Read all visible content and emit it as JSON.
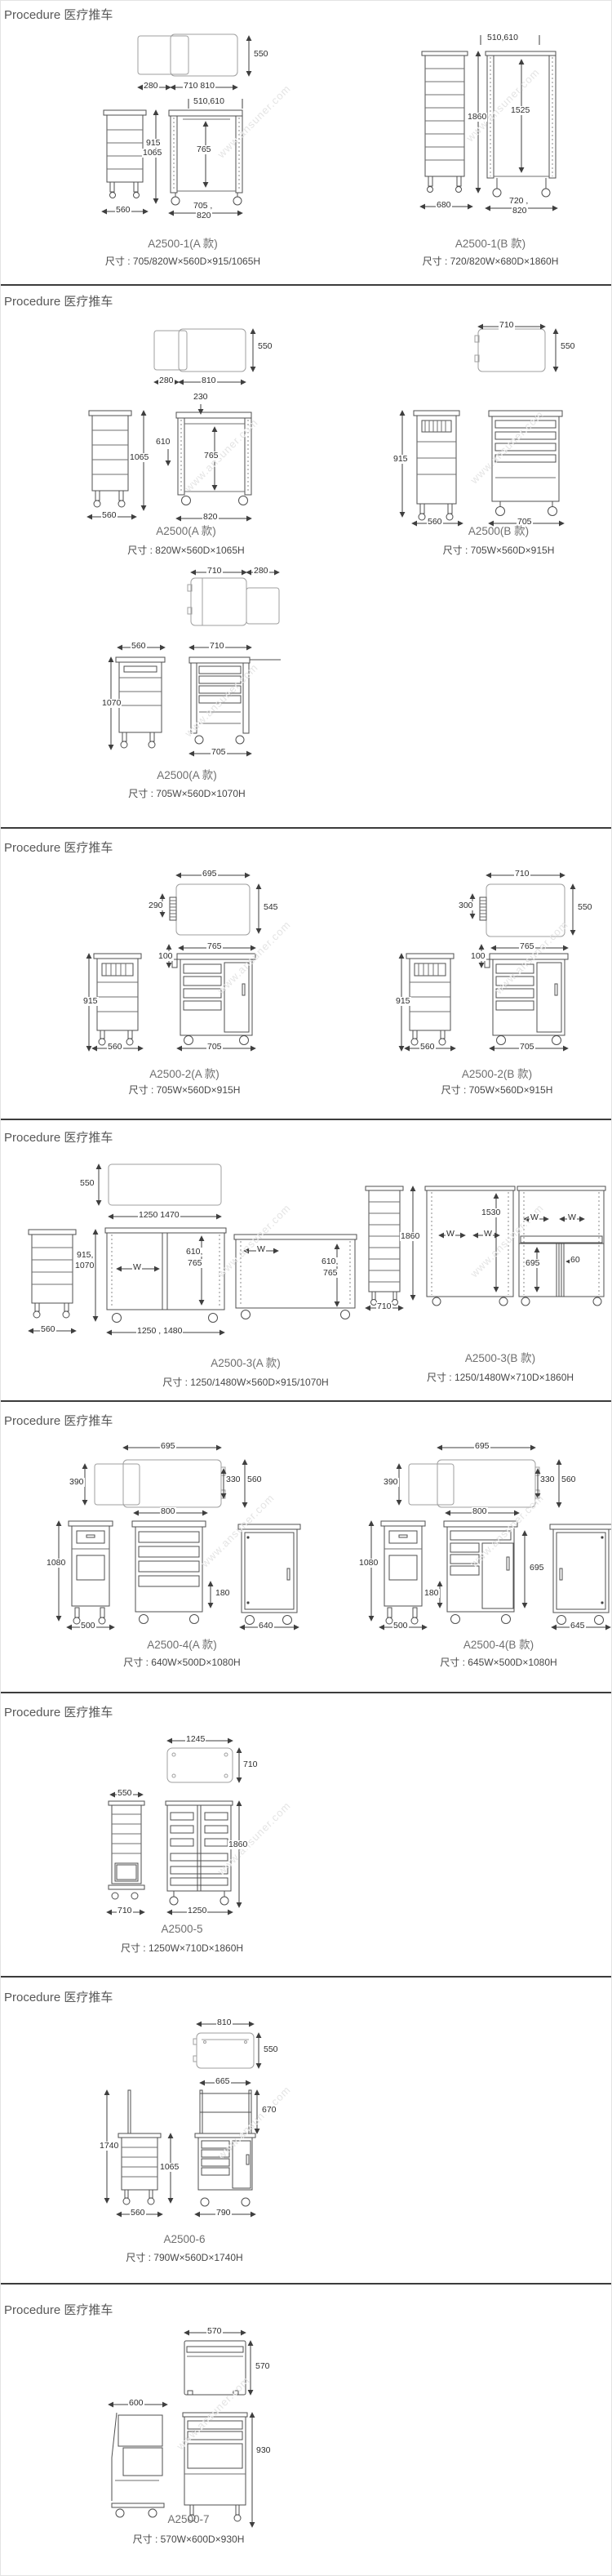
{
  "watermark": "www.ansuner.com",
  "sections": [
    {
      "header": "Procedure 医疗推车",
      "products": [
        {
          "name": "A2500-1(A 款)",
          "size": "尺寸 : 705/820W×560D×915/1065H",
          "dims": [
            "550",
            "280",
            "710 810",
            "510,610",
            "915",
            "1065",
            "765",
            "560",
            "705 ,",
            "820"
          ]
        },
        {
          "name": "A2500-1(B 款)",
          "size": "尺寸 : 720/820W×680D×1860H",
          "dims": [
            "510,610",
            "1860",
            "1525",
            "680",
            "720 ,",
            "820"
          ]
        }
      ]
    },
    {
      "header": "Procedure 医疗推车",
      "products": [
        {
          "name": "A2500(A 款)",
          "size": "尺寸 : 820W×560D×1065H",
          "dims": [
            "550",
            "280",
            "810",
            "230",
            "610",
            "765",
            "1065",
            "560",
            "820"
          ]
        },
        {
          "name": "A2500(B 款)",
          "size": "尺寸 : 705W×560D×915H",
          "dims": [
            "710",
            "550",
            "915",
            "560",
            "705"
          ]
        },
        {
          "name": "A2500(A 款)",
          "size": "尺寸 : 705W×560D×1070H",
          "dims": [
            "710",
            "280",
            "560",
            "710",
            "1070",
            "705"
          ]
        }
      ]
    },
    {
      "header": "Procedure 医疗推车",
      "products": [
        {
          "name": "A2500-2(A 款)",
          "size": "尺寸 : 705W×560D×915H",
          "dims": [
            "695",
            "290",
            "545",
            "765",
            "100",
            "915",
            "560",
            "705"
          ]
        },
        {
          "name": "A2500-2(B 款)",
          "size": "尺寸 : 705W×560D×915H",
          "dims": [
            "710",
            "300",
            "550",
            "765",
            "100",
            "915",
            "560",
            "705"
          ]
        }
      ]
    },
    {
      "header": "Procedure 医疗推车",
      "products": [
        {
          "name": "A2500-3(A 款)",
          "size": "尺寸 : 1250/1480W×560D×915/1070H",
          "dims": [
            "550",
            "1250 1470",
            "915,",
            "1070",
            "W",
            "610,",
            "765",
            "560",
            "1250 , 1480",
            "W",
            "610,",
            "765"
          ]
        },
        {
          "name": "A2500-3(B 款)",
          "size": "尺寸 : 1250/1480W×710D×1860H",
          "dims": [
            "1860",
            "710",
            "1530",
            "W",
            "W",
            "W",
            "W",
            "695",
            "60"
          ]
        }
      ]
    },
    {
      "header": "Procedure 医疗推车",
      "products": [
        {
          "name": "A2500-4(A 款)",
          "size": "尺寸 : 640W×500D×1080H",
          "dims": [
            "695",
            "390",
            "330",
            "560",
            "800",
            "1080",
            "180",
            "500",
            "640"
          ]
        },
        {
          "name": "A2500-4(B 款)",
          "size": "尺寸 : 645W×500D×1080H",
          "dims": [
            "695",
            "390",
            "330",
            "560",
            "800",
            "1080",
            "180",
            "695",
            "500",
            "645"
          ]
        }
      ]
    },
    {
      "header": "Procedure 医疗推车",
      "products": [
        {
          "name": "A2500-5",
          "size": "尺寸 : 1250W×710D×1860H",
          "dims": [
            "1245",
            "710",
            "550",
            "1860",
            "710",
            "1250"
          ]
        }
      ]
    },
    {
      "header": "Procedure 医疗推车",
      "products": [
        {
          "name": "A2500-6",
          "size": "尺寸 : 790W×560D×1740H",
          "dims": [
            "810",
            "550",
            "665",
            "670",
            "1740",
            "1065",
            "560",
            "790"
          ]
        }
      ]
    },
    {
      "header": "Procedure 医疗推车",
      "products": [
        {
          "name": "A2500-7",
          "size": "尺寸 : 570W×600D×930H",
          "dims": [
            "570",
            "570",
            "600",
            "930"
          ]
        }
      ]
    }
  ]
}
